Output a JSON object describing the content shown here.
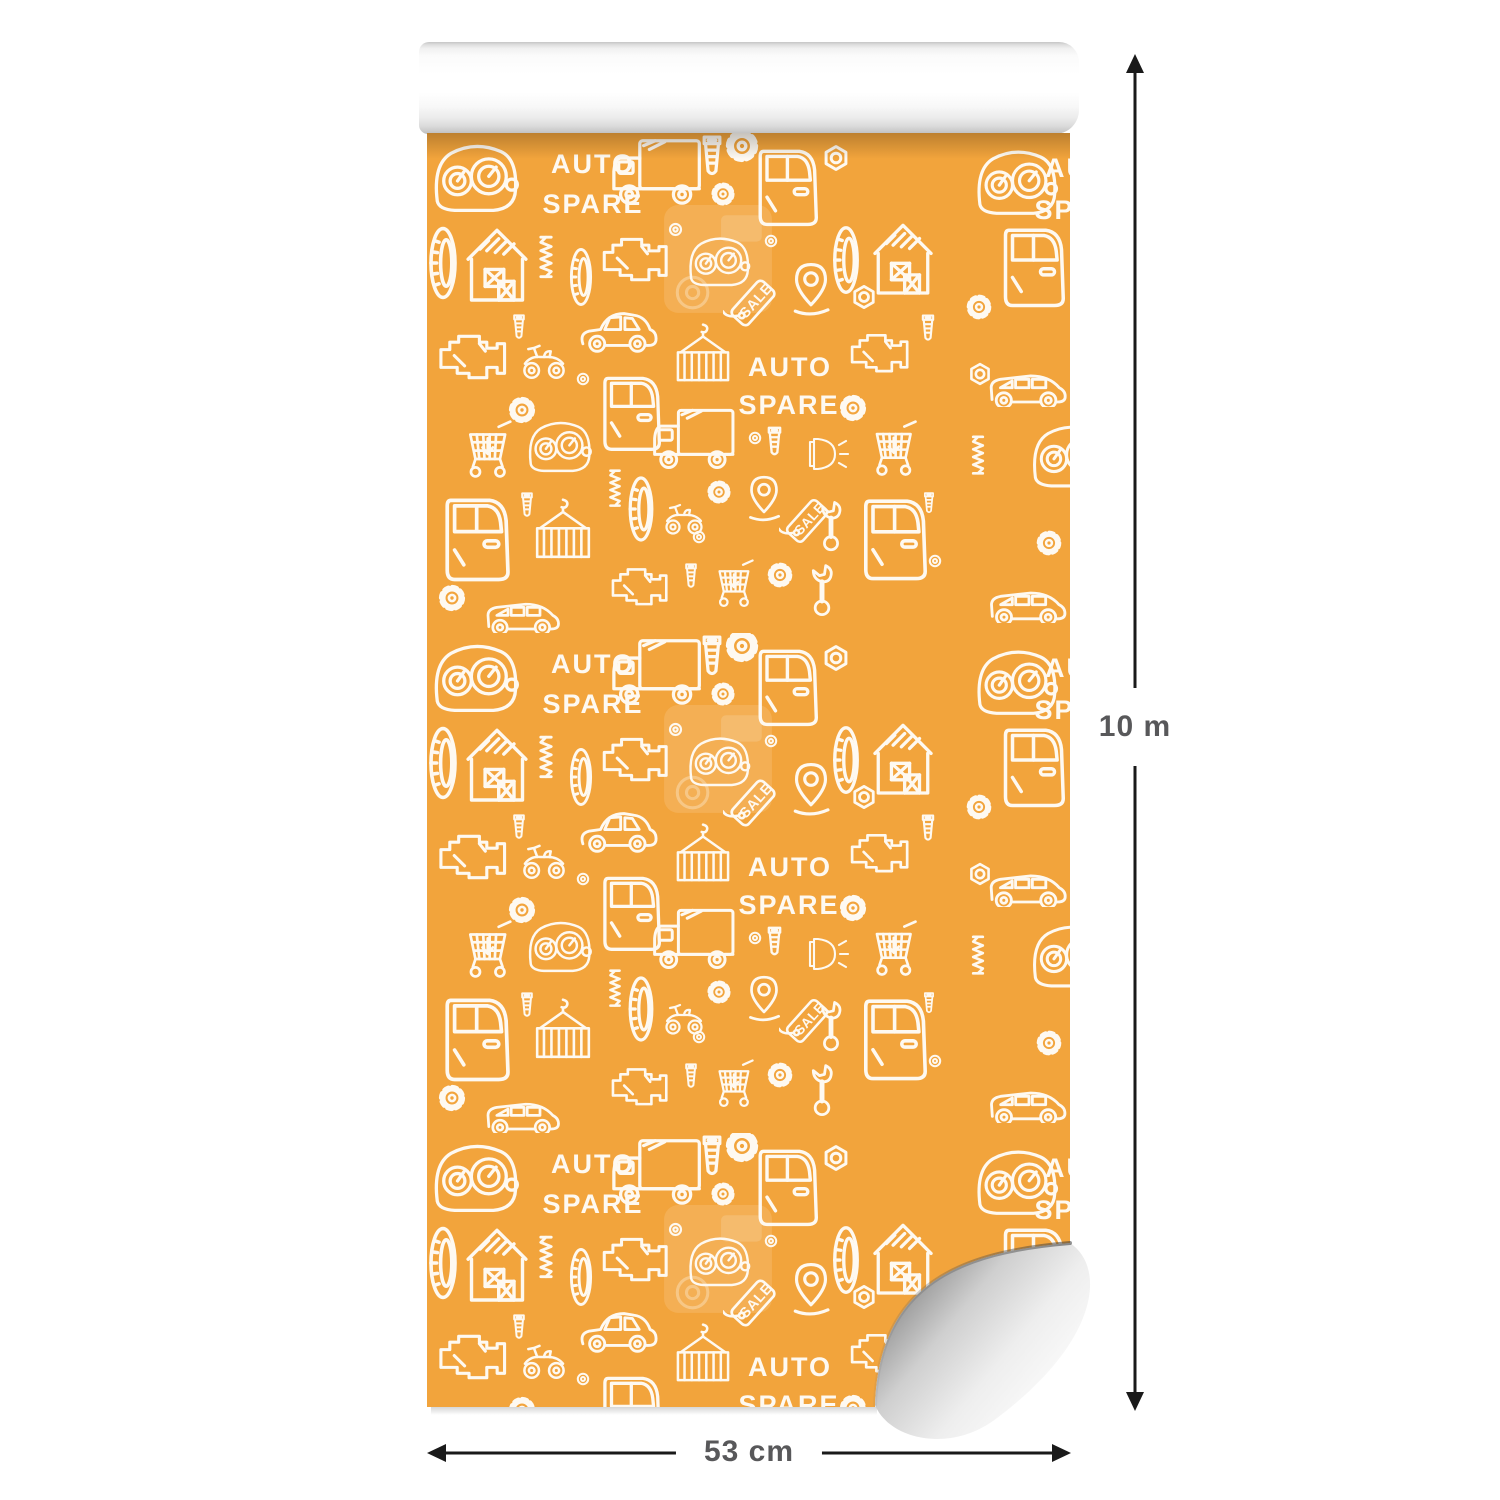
{
  "dimensions": {
    "height_label": "10 m",
    "width_label": "53 cm"
  },
  "pattern": {
    "word_auto": "AUTO",
    "word_spare": "SPARE",
    "word_sale": "SALE",
    "base_color": "#F2A43C",
    "doodle_color": "#FFFFFF",
    "motifs": [
      "dashboard-gauges",
      "auto-spare-lettering",
      "box-truck",
      "screw-bolt",
      "gear",
      "car-door",
      "hex-nut",
      "tire",
      "garage-with-crates",
      "engine-block",
      "hatchback-car",
      "minivan",
      "shopping-cart",
      "location-pin",
      "sale-tag",
      "wrench",
      "headlight",
      "hoisted-cargo-container",
      "quad-bike",
      "spring",
      "washer"
    ]
  },
  "colors": {
    "background": "#FFFFFF",
    "roll_core": "#FFFFFF",
    "dimension_line": "#1A1A1A",
    "dimension_text": "#58585A"
  }
}
